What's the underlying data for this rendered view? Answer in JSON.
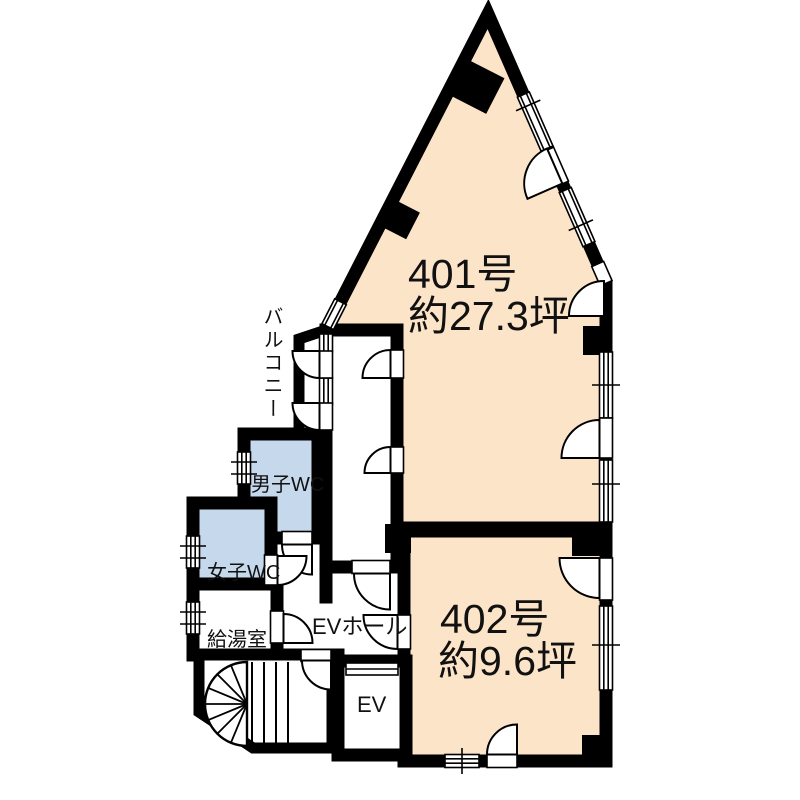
{
  "colors": {
    "room_fill": "#fce4c9",
    "wc_fill": "#c6d9ec",
    "wall": "#000000",
    "background": "#ffffff"
  },
  "rooms": {
    "r401": {
      "name": "401号",
      "area": "約27.3坪"
    },
    "r402": {
      "name": "402号",
      "area": "約9.6坪"
    },
    "balcony": {
      "label": "バルコニー"
    },
    "mens_wc": {
      "label": "男子WC"
    },
    "womens_wc": {
      "label": "女子WC"
    },
    "kitchenette": {
      "label": "給湯室"
    },
    "ev_hall": {
      "label": "EVホール"
    },
    "elevator": {
      "label": "EV"
    }
  }
}
